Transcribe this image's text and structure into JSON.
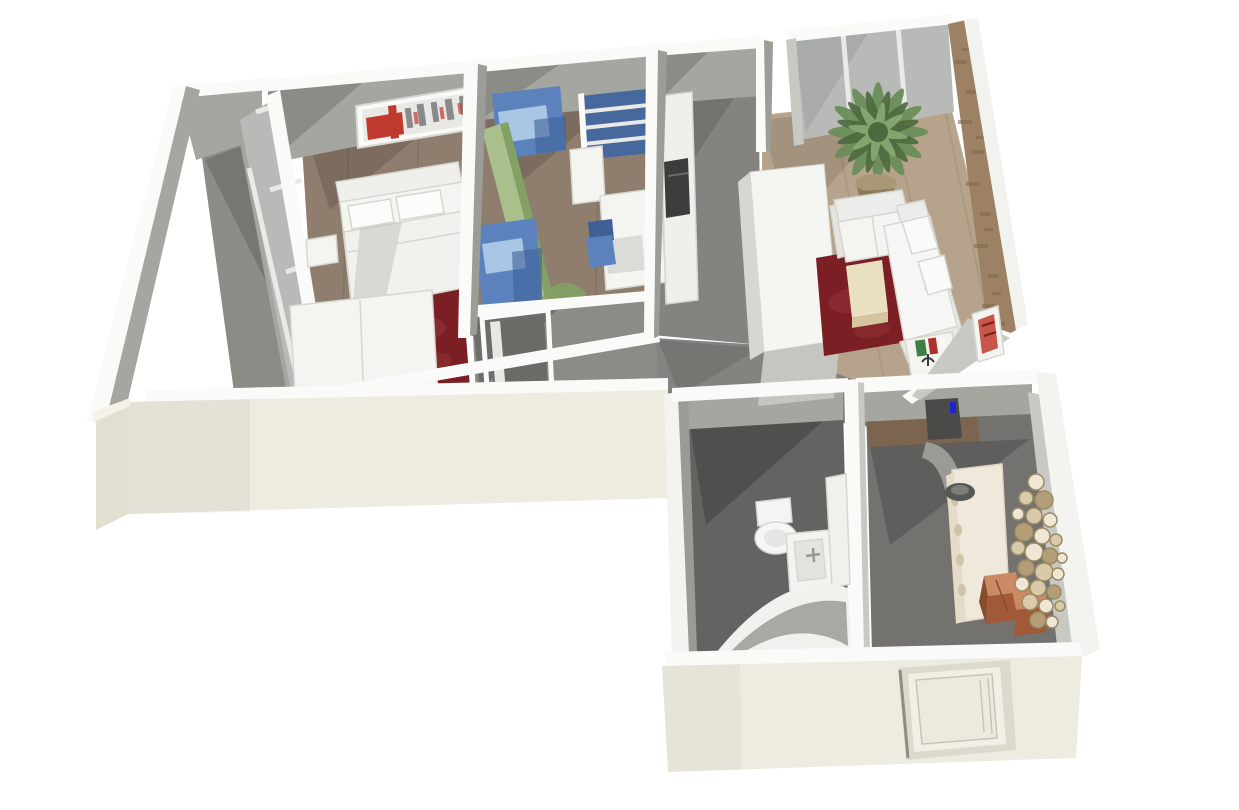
{
  "meta": {
    "description": "3D rendered dollhouse-view floor plan of an L-shaped two-bedroom apartment on a white background",
    "view": "isometric top-down 3D render",
    "background": "#ffffff"
  },
  "palette": {
    "bg": "#ffffff",
    "wall-top": "#fafaf8",
    "wall-face": "#a6a6a1",
    "wall-face-dark": "#8c8c87",
    "wall-face-light": "#c9c9c4",
    "cream": "#eeebe0",
    "cream-dark": "#e3dfd0",
    "cream-light": "#f4f2e9",
    "wood-bedroom": "#8f7d6e",
    "wood-bedroom-dark": "#77665a",
    "wood-living": "#b6a38c",
    "wood-living-dark": "#a08c74",
    "wood-hall": "#7b6450",
    "accent-wall": "#9c8165",
    "accent-wall-dark": "#7f674c",
    "gray-floor": "#84837f",
    "gray-floor-dark": "#6d6d6a",
    "bath-floor": "#636361",
    "entry-floor": "#73726f",
    "glass": "#b7bab6",
    "mullion": "#e9e9e5",
    "white-furn": "#f4f4f1",
    "white-furn-shadow": "#d7d7d1",
    "white-furn-dark": "#c6c6c0",
    "rug-red": "#7b1f24",
    "rug-red-light": "#96343a",
    "table-cream": "#e9dfc1",
    "table-cream-dark": "#d4c5a0",
    "blue": "#5b82bd",
    "blue-light": "#a9c6e5",
    "blue-dark": "#3f6096",
    "navy-shelf": "#46689c",
    "green": "#a9bf8c",
    "green-dark": "#83a164",
    "plant-green": "#6b8d5a",
    "plant-green-dark": "#4c6a3e",
    "plant-green-light": "#8aab74",
    "pot": "#a99878",
    "pot-dark": "#8d7c5c",
    "copper": "#c98a64",
    "copper-mid": "#a05a38",
    "copper-dark": "#8a4c30",
    "art-red": "#bf3a2e",
    "art-gray": "#8a8a8a",
    "disc-beige": "#d9cba9",
    "disc-light": "#efe7d4",
    "disc-dark": "#b49e77",
    "disc-stroke": "#9a8a66",
    "appliance-dark": "#3c3c3c",
    "door-frame": "#dcd9cd",
    "door-panel": "#f1efe6",
    "bowl-dark": "#575755",
    "book-green": "#3f7f46",
    "book-red": "#b03030",
    "doorway-dark": "#4a4a48",
    "detail-blue": "#2222cc"
  },
  "scene": {
    "rooms": [
      {
        "id": "master-bedroom",
        "floor": "wood",
        "furniture": [
          "double-bed",
          "pillows",
          "nightstand",
          "dresser",
          "bedroom-rug",
          "city-skyline-artwork",
          "window-wall"
        ]
      },
      {
        "id": "kids-room",
        "floor": "wood",
        "furniture": [
          "bunk-bed-upper",
          "green-slide",
          "bunk-bed-lower",
          "wall-bookshelf",
          "desk",
          "desk-chair",
          "storage-cabinet"
        ]
      },
      {
        "id": "kitchen-corridor",
        "floor": "gray",
        "furniture": [
          "counter-run",
          "dark-appliance",
          "tall-island-unit"
        ]
      },
      {
        "id": "living-room",
        "floor": "light-wood",
        "furniture": [
          "panorama-window",
          "palm-plant",
          "sectional-sofa",
          "coffee-table",
          "living-rug",
          "media-shelf",
          "books",
          "red-artwork",
          "textured-accent-wall"
        ]
      },
      {
        "id": "closet-hall",
        "floor": "gray",
        "furniture": [
          "open-door"
        ]
      },
      {
        "id": "bathroom",
        "floor": "dark-gray",
        "furniture": [
          "toilet",
          "sink-vanity",
          "mirror-cabinet",
          "corner-bathtub"
        ]
      },
      {
        "id": "entry-hall",
        "floor": "dark-gray",
        "furniture": [
          "console-table",
          "decor-bowl",
          "copper-boxes",
          "circle-wall-art",
          "front-door"
        ]
      },
      {
        "id": "balcony",
        "floor": "gray",
        "furniture": []
      }
    ]
  }
}
